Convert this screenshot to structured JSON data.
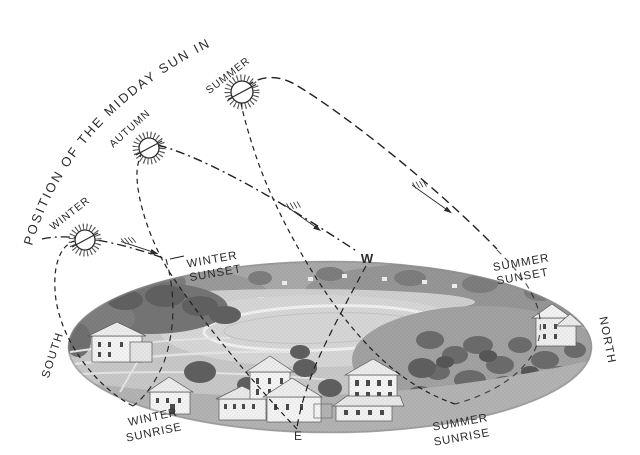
{
  "title": "POSITION OF THE MIDDAY SUN IN",
  "sun_paths": {
    "winter": {
      "label": "WINTER"
    },
    "autumn": {
      "label": "AUTUMN"
    },
    "summer": {
      "label": "SUMMER"
    }
  },
  "compass": {
    "west": "W",
    "east": "E",
    "south": "SOUTH",
    "north": "NORTH"
  },
  "horizon_events": {
    "winter_sunset": {
      "line1": "WINTER",
      "line2": "SUNSET"
    },
    "summer_sunset": {
      "line1": "SUMMER",
      "line2": "SUNSET"
    },
    "winter_sunrise": {
      "line1": "WINTER",
      "line2": "SUNRISE"
    },
    "summer_sunrise": {
      "line1": "SUMMER",
      "line2": "SUNRISE"
    }
  },
  "icons": {
    "sun": "sun-icon",
    "motion_arrow": "feathered-arrow-icon"
  },
  "colors": {
    "ink": "#2b2b2b",
    "line": "#1f1f1f",
    "paper": "#ffffff"
  }
}
